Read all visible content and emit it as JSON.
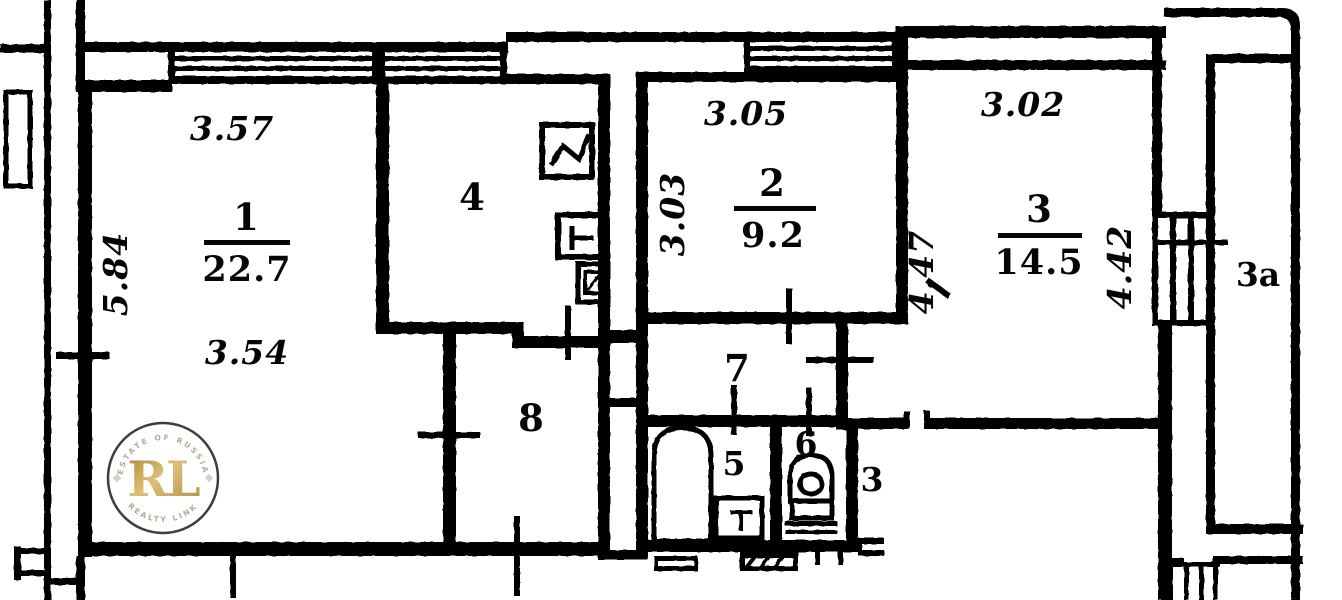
{
  "plan": {
    "room1": {
      "number": "1",
      "area": "22.7",
      "dim_top": "3.57",
      "dim_left": "5.84",
      "dim_bottom": "3.54"
    },
    "room2": {
      "number": "2",
      "area": "9.2",
      "dim_top": "3.05",
      "dim_left": "3.03"
    },
    "room3": {
      "number": "3",
      "area": "14.5",
      "dim_top": "3.02",
      "dim_left": "4.47",
      "dim_right": "4.42"
    },
    "room3_annex": {
      "number": "3"
    },
    "room3a": {
      "number": "3a"
    },
    "room4": {
      "number": "4"
    },
    "room5": {
      "number": "5"
    },
    "room6": {
      "number": "6"
    },
    "room7": {
      "number": "7"
    },
    "room8": {
      "number": "8"
    }
  },
  "watermark": {
    "monogram": "RL",
    "arc_top": "ESTATE OF RUSSIA",
    "arc_bottom": "REALTY LINK"
  },
  "colors": {
    "ink": "#050505",
    "paper": "#ffffff",
    "gold": "#c2a054",
    "ring": "#3d3d3d",
    "arc_text": "#b3a996",
    "diamond": "#d9d0c2"
  }
}
